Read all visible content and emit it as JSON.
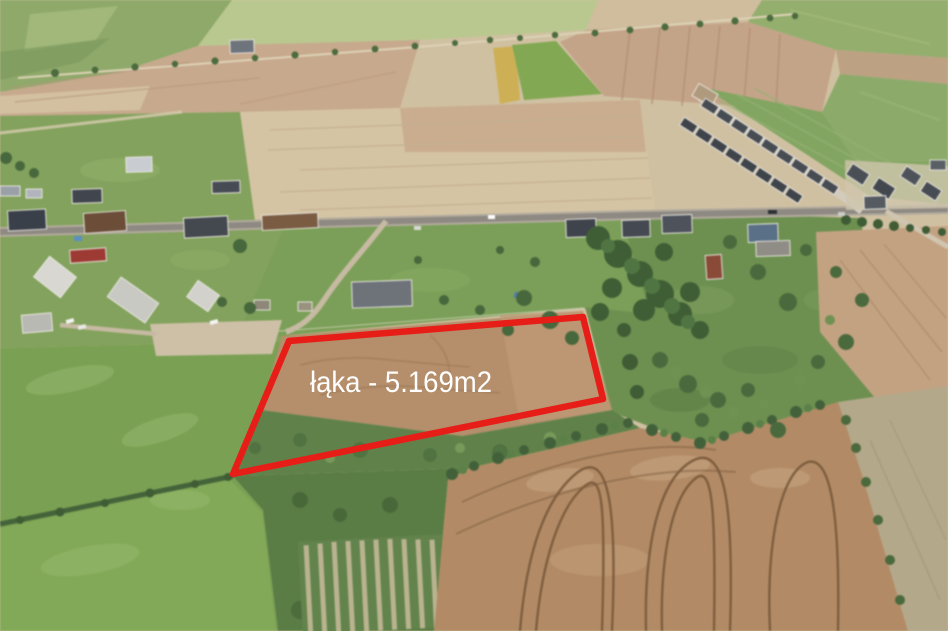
{
  "annotation": {
    "label": "łąka - 5.169m2",
    "label_color": "#ffffff",
    "label_x": 310,
    "label_y": 392,
    "outline_color": "#e71d18",
    "outline_points": "289,341 583,317 603,399 233,474"
  }
}
